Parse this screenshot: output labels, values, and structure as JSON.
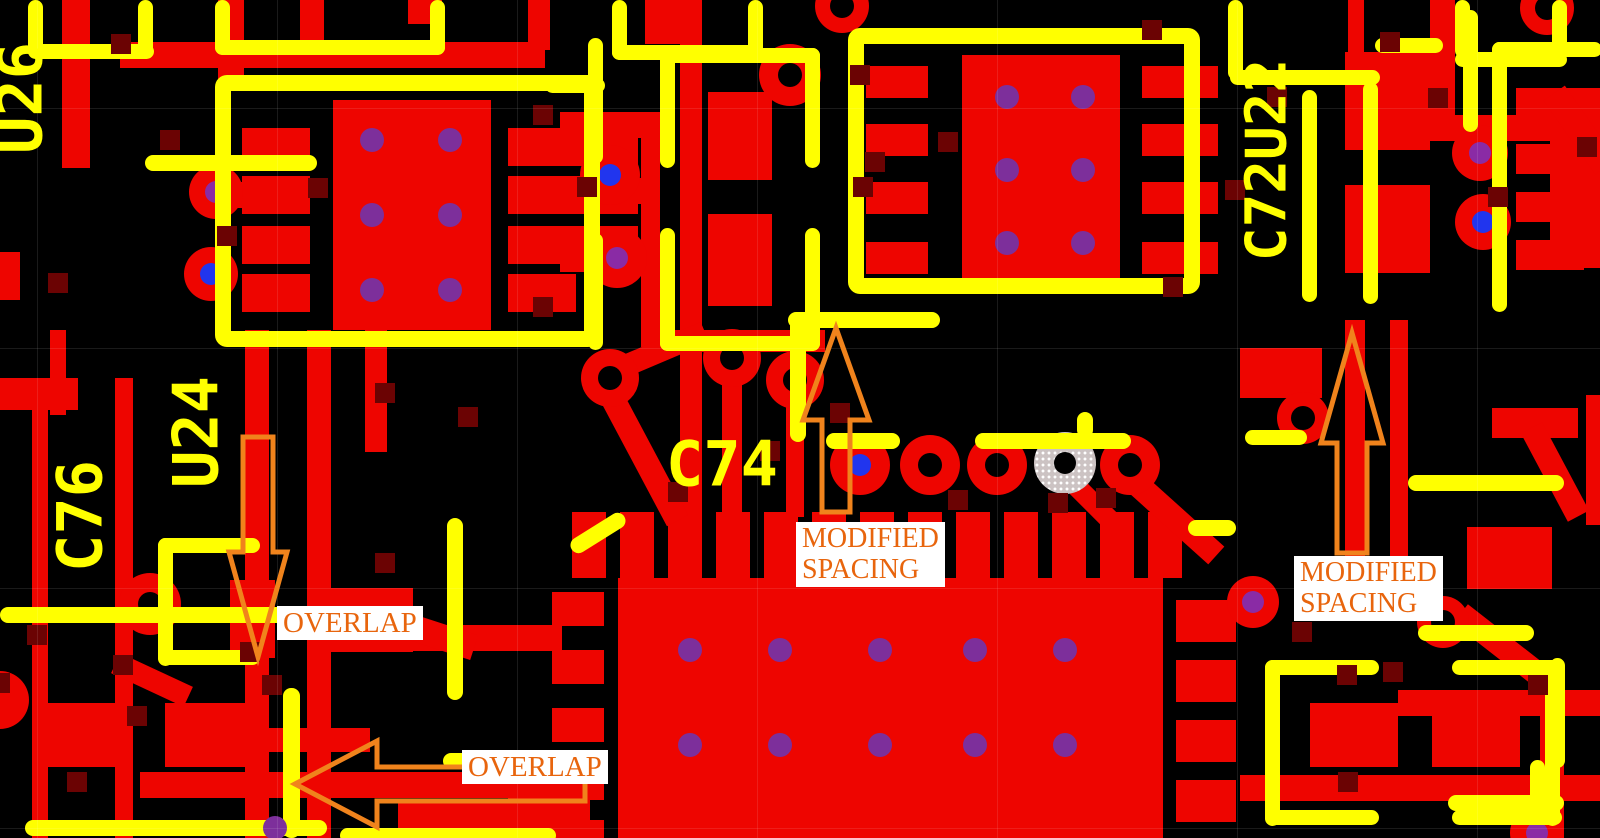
{
  "view": {
    "type_label": "pcb-layout-view"
  },
  "colors": {
    "bg": "#000000",
    "copper": "#EE0500",
    "silk": "#FFFF00",
    "via_square": "#6B0303",
    "hole_black": "#000000",
    "hole_blue": "#2135EE",
    "hole_purple": "#8A2BA5",
    "dot_purple": "#7D2F9B",
    "pad_gray": "#CCC3C3",
    "annot_stroke": "#F0831C",
    "annot_text": "#E8650D",
    "annot_bg": "#FFFFFF"
  },
  "grid": {
    "vx": [
      37,
      277,
      517,
      757,
      997,
      1237,
      1477
    ],
    "hy": [
      108,
      348,
      588,
      828
    ]
  },
  "board": {
    "copper_rects": [
      [
        62,
        0,
        28,
        168
      ],
      [
        218,
        0,
        26,
        80
      ],
      [
        300,
        0,
        24,
        62
      ],
      [
        120,
        42,
        425,
        26
      ],
      [
        408,
        0,
        34,
        24
      ],
      [
        528,
        0,
        22,
        50
      ],
      [
        0,
        252,
        20,
        48
      ],
      [
        333,
        100,
        158,
        230
      ],
      [
        242,
        128,
        68,
        38
      ],
      [
        242,
        176,
        68,
        38
      ],
      [
        242,
        226,
        68,
        38
      ],
      [
        242,
        274,
        68,
        38
      ],
      [
        508,
        128,
        130,
        38
      ],
      [
        508,
        176,
        130,
        38
      ],
      [
        508,
        226,
        130,
        38
      ],
      [
        508,
        274,
        68,
        38
      ],
      [
        196,
        182,
        46,
        26
      ],
      [
        560,
        112,
        82,
        26
      ],
      [
        560,
        178,
        82,
        26
      ],
      [
        560,
        246,
        82,
        26
      ],
      [
        641,
        112,
        19,
        235
      ],
      [
        645,
        0,
        55,
        44
      ],
      [
        680,
        0,
        22,
        520
      ],
      [
        708,
        92,
        64,
        88
      ],
      [
        708,
        214,
        64,
        92
      ],
      [
        962,
        55,
        158,
        232
      ],
      [
        866,
        66,
        62,
        32
      ],
      [
        866,
        124,
        62,
        32
      ],
      [
        866,
        182,
        62,
        32
      ],
      [
        866,
        242,
        62,
        32
      ],
      [
        1142,
        66,
        76,
        32
      ],
      [
        1142,
        124,
        76,
        32
      ],
      [
        1142,
        182,
        76,
        32
      ],
      [
        1142,
        242,
        76,
        32
      ],
      [
        1348,
        0,
        16,
        52
      ],
      [
        1345,
        52,
        85,
        98
      ],
      [
        1345,
        185,
        85,
        88
      ],
      [
        1400,
        115,
        200,
        26
      ],
      [
        1430,
        0,
        25,
        118
      ],
      [
        1516,
        88,
        68,
        30
      ],
      [
        1516,
        144,
        68,
        30
      ],
      [
        1516,
        192,
        68,
        30
      ],
      [
        1516,
        240,
        68,
        30
      ],
      [
        1550,
        88,
        50,
        180
      ],
      [
        0,
        378,
        78,
        32
      ],
      [
        32,
        410,
        16,
        428
      ],
      [
        115,
        378,
        18,
        460
      ],
      [
        245,
        330,
        24,
        508
      ],
      [
        307,
        330,
        24,
        508
      ],
      [
        365,
        330,
        22,
        122
      ],
      [
        50,
        330,
        16,
        85
      ],
      [
        1240,
        348,
        82,
        50
      ],
      [
        1345,
        320,
        20,
        248
      ],
      [
        1390,
        320,
        18,
        248
      ],
      [
        1586,
        395,
        14,
        130
      ],
      [
        1467,
        527,
        85,
        62
      ],
      [
        1492,
        408,
        86,
        30
      ],
      [
        618,
        578,
        545,
        260
      ],
      [
        572,
        512,
        34,
        66
      ],
      [
        620,
        512,
        34,
        66
      ],
      [
        668,
        512,
        34,
        66
      ],
      [
        716,
        512,
        34,
        66
      ],
      [
        764,
        512,
        34,
        66
      ],
      [
        812,
        512,
        34,
        66
      ],
      [
        860,
        512,
        34,
        66
      ],
      [
        908,
        512,
        34,
        66
      ],
      [
        956,
        512,
        34,
        66
      ],
      [
        1004,
        512,
        34,
        66
      ],
      [
        1052,
        512,
        34,
        66
      ],
      [
        1100,
        512,
        34,
        66
      ],
      [
        1148,
        512,
        34,
        66
      ],
      [
        552,
        592,
        52,
        34
      ],
      [
        552,
        650,
        52,
        34
      ],
      [
        552,
        708,
        52,
        34
      ],
      [
        552,
        766,
        52,
        34
      ],
      [
        552,
        820,
        52,
        18
      ],
      [
        1176,
        600,
        60,
        42
      ],
      [
        1176,
        660,
        60,
        42
      ],
      [
        1176,
        720,
        60,
        42
      ],
      [
        1176,
        780,
        60,
        42
      ],
      [
        45,
        703,
        86,
        64
      ],
      [
        165,
        703,
        86,
        64
      ],
      [
        255,
        728,
        115,
        24
      ],
      [
        140,
        772,
        450,
        26
      ],
      [
        230,
        580,
        45,
        78
      ],
      [
        325,
        588,
        88,
        64
      ],
      [
        412,
        625,
        150,
        26
      ],
      [
        398,
        800,
        110,
        38
      ],
      [
        508,
        760,
        82,
        78
      ],
      [
        1310,
        703,
        88,
        64
      ],
      [
        1432,
        703,
        88,
        64
      ],
      [
        1398,
        690,
        202,
        26
      ],
      [
        1240,
        775,
        360,
        26
      ],
      [
        1540,
        690,
        24,
        148
      ],
      [
        722,
        380,
        20,
        135
      ],
      [
        786,
        392,
        18,
        125
      ],
      [
        655,
        330,
        170,
        22
      ]
    ],
    "copper_diagonals": [
      [
        640,
        450,
        160,
        24,
        62
      ],
      [
        658,
        352,
        102,
        22,
        -23
      ],
      [
        1168,
        512,
        130,
        24,
        42
      ],
      [
        1085,
        495,
        70,
        20,
        45
      ],
      [
        152,
        680,
        80,
        22,
        25
      ],
      [
        438,
        636,
        75,
        26,
        18
      ],
      [
        1507,
        650,
        118,
        24,
        38
      ],
      [
        1580,
        130,
        90,
        26,
        55
      ],
      [
        1555,
        472,
        100,
        24,
        62
      ]
    ],
    "round_pads": [
      [
        216,
        192,
        27,
        "purple"
      ],
      [
        211,
        274,
        27,
        "blue"
      ],
      [
        150,
        604,
        31,
        "black"
      ],
      [
        610,
        175,
        30,
        "blue"
      ],
      [
        617,
        258,
        30,
        "purple"
      ],
      [
        790,
        75,
        31,
        "black"
      ],
      [
        610,
        378,
        29,
        "black"
      ],
      [
        732,
        358,
        29,
        "black"
      ],
      [
        795,
        380,
        29,
        "black"
      ],
      [
        860,
        465,
        30,
        "blue"
      ],
      [
        930,
        465,
        30,
        "black"
      ],
      [
        997,
        465,
        30,
        "black"
      ],
      [
        1130,
        465,
        30,
        "black"
      ],
      [
        1303,
        418,
        26,
        "black"
      ],
      [
        1480,
        153,
        28,
        "purple"
      ],
      [
        1483,
        222,
        28,
        "blue"
      ],
      [
        1547,
        8,
        27,
        "black"
      ],
      [
        1253,
        602,
        26,
        "purple"
      ],
      [
        1443,
        622,
        26,
        "black"
      ],
      [
        1537,
        833,
        27,
        "purple"
      ],
      [
        842,
        6,
        27,
        "black"
      ],
      [
        0,
        700,
        29,
        "none"
      ]
    ],
    "gray_pad": [
      1065,
      463,
      31
    ],
    "thermal_dots": [
      [
        372,
        140
      ],
      [
        450,
        140
      ],
      [
        372,
        215
      ],
      [
        450,
        215
      ],
      [
        372,
        290
      ],
      [
        450,
        290
      ],
      [
        1007,
        97
      ],
      [
        1083,
        97
      ],
      [
        1007,
        170
      ],
      [
        1083,
        170
      ],
      [
        1007,
        243
      ],
      [
        1083,
        243
      ],
      [
        690,
        650
      ],
      [
        780,
        650
      ],
      [
        880,
        650
      ],
      [
        975,
        650
      ],
      [
        1065,
        650
      ],
      [
        690,
        745
      ],
      [
        780,
        745
      ],
      [
        880,
        745
      ],
      [
        975,
        745
      ],
      [
        1065,
        745
      ],
      [
        275,
        828
      ]
    ],
    "via_squares": [
      [
        121,
        44
      ],
      [
        170,
        140
      ],
      [
        227,
        236
      ],
      [
        318,
        188
      ],
      [
        543,
        115
      ],
      [
        587,
        187
      ],
      [
        543,
        307
      ],
      [
        58,
        283
      ],
      [
        385,
        393
      ],
      [
        468,
        417
      ],
      [
        385,
        563
      ],
      [
        250,
        652
      ],
      [
        137,
        716
      ],
      [
        123,
        665
      ],
      [
        37,
        635
      ],
      [
        0,
        683
      ],
      [
        77,
        782
      ],
      [
        272,
        685
      ],
      [
        860,
        75
      ],
      [
        948,
        142
      ],
      [
        1152,
        30
      ],
      [
        1173,
        287
      ],
      [
        863,
        187
      ],
      [
        875,
        162
      ],
      [
        678,
        492
      ],
      [
        770,
        451
      ],
      [
        840,
        413
      ],
      [
        958,
        500
      ],
      [
        1058,
        503
      ],
      [
        1106,
        498
      ],
      [
        1235,
        190
      ],
      [
        1277,
        97
      ],
      [
        1390,
        42
      ],
      [
        1438,
        98
      ],
      [
        1498,
        197
      ],
      [
        1587,
        147
      ],
      [
        1302,
        632
      ],
      [
        1347,
        675
      ],
      [
        1393,
        672
      ],
      [
        1538,
        685
      ],
      [
        1348,
        782
      ]
    ],
    "silk_segments": [
      [
        28,
        0,
        15,
        58
      ],
      [
        138,
        0,
        15,
        58
      ],
      [
        28,
        44,
        126,
        15
      ],
      [
        215,
        0,
        15,
        55
      ],
      [
        430,
        0,
        15,
        55
      ],
      [
        215,
        40,
        230,
        15
      ],
      [
        612,
        0,
        15,
        60
      ],
      [
        748,
        0,
        15,
        60
      ],
      [
        612,
        45,
        152,
        15
      ],
      [
        1228,
        0,
        15,
        80
      ],
      [
        1230,
        70,
        150,
        15
      ],
      [
        1363,
        82,
        15,
        222
      ],
      [
        1302,
        90,
        15,
        212
      ],
      [
        1455,
        0,
        15,
        58
      ],
      [
        1552,
        0,
        15,
        58
      ],
      [
        1455,
        52,
        112,
        15
      ],
      [
        145,
        155,
        172,
        16
      ],
      [
        660,
        48,
        160,
        15
      ],
      [
        660,
        336,
        160,
        15
      ],
      [
        660,
        48,
        15,
        120
      ],
      [
        660,
        228,
        15,
        123
      ],
      [
        805,
        48,
        15,
        120
      ],
      [
        805,
        228,
        15,
        123
      ],
      [
        545,
        78,
        60,
        15
      ],
      [
        588,
        38,
        15,
        126
      ],
      [
        588,
        233,
        15,
        117
      ],
      [
        158,
        538,
        15,
        128
      ],
      [
        158,
        538,
        102,
        15
      ],
      [
        158,
        650,
        102,
        15
      ],
      [
        447,
        518,
        16,
        182
      ],
      [
        0,
        607,
        332,
        16
      ],
      [
        25,
        820,
        302,
        16
      ],
      [
        283,
        688,
        17,
        150
      ],
      [
        443,
        753,
        116,
        16
      ],
      [
        788,
        312,
        152,
        16
      ],
      [
        790,
        318,
        16,
        124
      ],
      [
        826,
        433,
        74,
        16
      ],
      [
        975,
        433,
        156,
        16
      ],
      [
        1077,
        412,
        16,
        26
      ],
      [
        1188,
        520,
        48,
        16
      ],
      [
        1245,
        430,
        62,
        15
      ],
      [
        1265,
        660,
        15,
        166
      ],
      [
        1265,
        660,
        114,
        15
      ],
      [
        1265,
        810,
        114,
        15
      ],
      [
        1545,
        660,
        15,
        166
      ],
      [
        1452,
        660,
        110,
        15
      ],
      [
        1452,
        810,
        110,
        15
      ],
      [
        1408,
        475,
        156,
        16
      ],
      [
        1418,
        625,
        116,
        16
      ],
      [
        1550,
        658,
        15,
        110
      ],
      [
        1530,
        760,
        15,
        46
      ],
      [
        1448,
        795,
        116,
        16
      ],
      [
        1492,
        42,
        15,
        270
      ],
      [
        1492,
        42,
        110,
        15
      ],
      [
        1463,
        10,
        15,
        122
      ],
      [
        1375,
        38,
        68,
        15
      ],
      [
        340,
        828,
        216,
        15
      ]
    ],
    "silk_diagonals": [
      [
        598,
        533,
        62,
        16,
        -32
      ]
    ],
    "silk_boxes": [
      [
        215,
        75,
        385,
        272
      ],
      [
        848,
        28,
        352,
        266
      ]
    ],
    "labels": [
      {
        "text": "U26",
        "cx": 20,
        "cy": 98,
        "rot": -90,
        "size": 62
      },
      {
        "text": "C76",
        "cx": 80,
        "cy": 516,
        "rot": -90,
        "size": 62
      },
      {
        "text": "U24",
        "cx": 196,
        "cy": 432,
        "rot": -90,
        "size": 62
      },
      {
        "text": "C74",
        "cx": 722,
        "cy": 464,
        "rot": 0,
        "size": 62
      },
      {
        "text": "C72U22",
        "cx": 1267,
        "cy": 160,
        "rot": -90,
        "size": 56
      }
    ]
  },
  "annotations": {
    "boxes": [
      {
        "name": "overlap-label-1",
        "x": 277,
        "y": 606,
        "font": 29,
        "lines": [
          "OVERLAP"
        ]
      },
      {
        "name": "overlap-label-2",
        "x": 462,
        "y": 750,
        "font": 29,
        "lines": [
          "OVERLAP"
        ]
      },
      {
        "name": "modified-spacing-label-1",
        "x": 796,
        "y": 522,
        "font": 28,
        "lines": [
          "MODIFIED",
          "SPACING"
        ]
      },
      {
        "name": "modified-spacing-label-2",
        "x": 1294,
        "y": 556,
        "font": 28,
        "lines": [
          "MODIFIED",
          "SPACING"
        ]
      }
    ],
    "arrows": [
      {
        "name": "overlap-arrow-down",
        "points": "258,657 229,552 243,552 243,437 273,437 273,552 287,552"
      },
      {
        "name": "overlap-arrow-left",
        "points": "295,784 377,741 377,767 585,767 585,801 377,801 377,827"
      },
      {
        "name": "modified-spacing-arrow-up-1",
        "points": "836,328 803,420 822,420 822,512 850,512 850,420 869,420"
      },
      {
        "name": "modified-spacing-arrow-up-2",
        "points": "1352,333 1321,443 1337,443 1337,553 1367,553 1367,443 1383,443"
      }
    ]
  }
}
